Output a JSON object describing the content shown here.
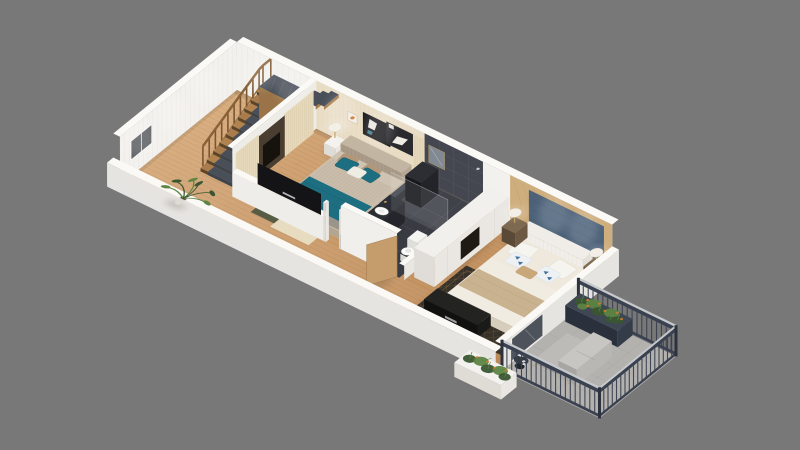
{
  "scene": {
    "type": "3d-isometric-floor-plan-render",
    "description": "Photorealistic 3D cutaway floor plan of a narrow apartment viewed at an angle on a plain gray background: entry hall with wooden staircase and potted palm, first bedroom with teal bedding, dark tiled bathroom, closet nook, master bedroom with blue upholstered headboard wall, long corridor, and a balcony with dark railing, planters and a gray lounge chair",
    "rooms": [
      {
        "name": "stair-hall",
        "features": [
          "wooden-open-staircase",
          "dark-gray-stair-runner",
          "west-side-railing",
          "potted-palm-plant",
          "window-in-end-wall"
        ]
      },
      {
        "name": "bedroom-1",
        "features": [
          "double-bed",
          "teal-throw-blanket",
          "striped-taupe-duvet",
          "teal-and-taupe-pillows",
          "dark-abstract-wall-art",
          "beige-wallpaper",
          "cream-curtains",
          "dark-wardrobe-with-niche",
          "tv-half-wall",
          "olive-green-rug",
          "cream-rug",
          "white-nightstand-with-lamp"
        ]
      },
      {
        "name": "bathroom",
        "features": [
          "dark-charcoal-tiles",
          "dark-vanity-with-white-oval-sink",
          "wall-mirror",
          "toilet",
          "shower-glass-screen",
          "tall-dark-cabinet",
          "open-wooden-door",
          "low-shelf-wall-with-tray"
        ]
      },
      {
        "name": "closet-nook",
        "features": [
          "white-wardrobe-with-dark-niche"
        ]
      },
      {
        "name": "master-bedroom",
        "features": [
          "double-bed-cream-bedding",
          "white-channel-tufted-headboard",
          "blue-upholstered-headboard-panel",
          "gold-patterned-wood-panel-wall",
          "white-and-blue-print-pillows",
          "tan-folded-blanket",
          "two-wood-nightstands",
          "two-white-shade-lamps",
          "dark-rug-with-gold-lattice",
          "dark-media-console",
          "balcony-doorway"
        ]
      },
      {
        "name": "corridor",
        "features": [
          "light-oak-plank-floor"
        ]
      },
      {
        "name": "balcony",
        "features": [
          "dark-metal-railing-with-light-cap",
          "planter-with-green-plants-and-orange-flowers",
          "gray-lounge-chair",
          "round-dark-side-table-with-kettle",
          "gray-tile-floor",
          "hanging-planter-outside-wall"
        ]
      }
    ],
    "palette": {
      "background": "#787878",
      "floor_wood_light": "#d7ab7c",
      "floor_wood_dark": "#bc8a59",
      "floor_plank_line": "#8a5a2e",
      "wall_interior": "#f3f1ed",
      "wall_top": "#faf9f5",
      "wall_exterior": "#e6e4e0",
      "wallpaper_beige": "#e9ddc6",
      "wood_panel": "#cfae7e",
      "panel_gold_line": "#b28e55",
      "headboard_panel_blue": "#4d6279",
      "bathroom_tile_dark": "#383b42",
      "bathroom_tile_wall": "#44474f",
      "teal_bedding": "#1d6e80",
      "taupe_textile": "#b29878",
      "bed1_base_gray": "#9a948a",
      "duvet_striped": "#c9bcaa",
      "master_duvet_cream": "#f1ece1",
      "master_blanket_tan": "#c9b28f",
      "pillow_white": "#f6f4ef",
      "pillow_print_blue": "#44719c",
      "rug_olive_green": "#545a42",
      "rug_cream": "#e8dcc0",
      "master_rug_dark": "#39322a",
      "master_rug_gold": "#a3894f",
      "stair_wood": "#a97c4d",
      "stair_runner_gray": "#494f59",
      "railing_dark": "#3a4150",
      "railing_cap_light": "#c6c8cb",
      "balcony_floor_gray": "#b4b2ae",
      "plant_green_dark": "#3a5630",
      "plant_green_light": "#5d8443",
      "flower_orange": "#cd7a2f",
      "furniture_dark": "#141416",
      "door_wood": "#c59c6b",
      "nightstand_wood": "#73604a",
      "brass_gold": "#c2a060",
      "lamp_shade_white": "#f3efe6",
      "ceramic_white": "#fafaf8",
      "window_glass_gray": "#5c5f63",
      "lounge_gray": "#bdbbb8"
    }
  }
}
